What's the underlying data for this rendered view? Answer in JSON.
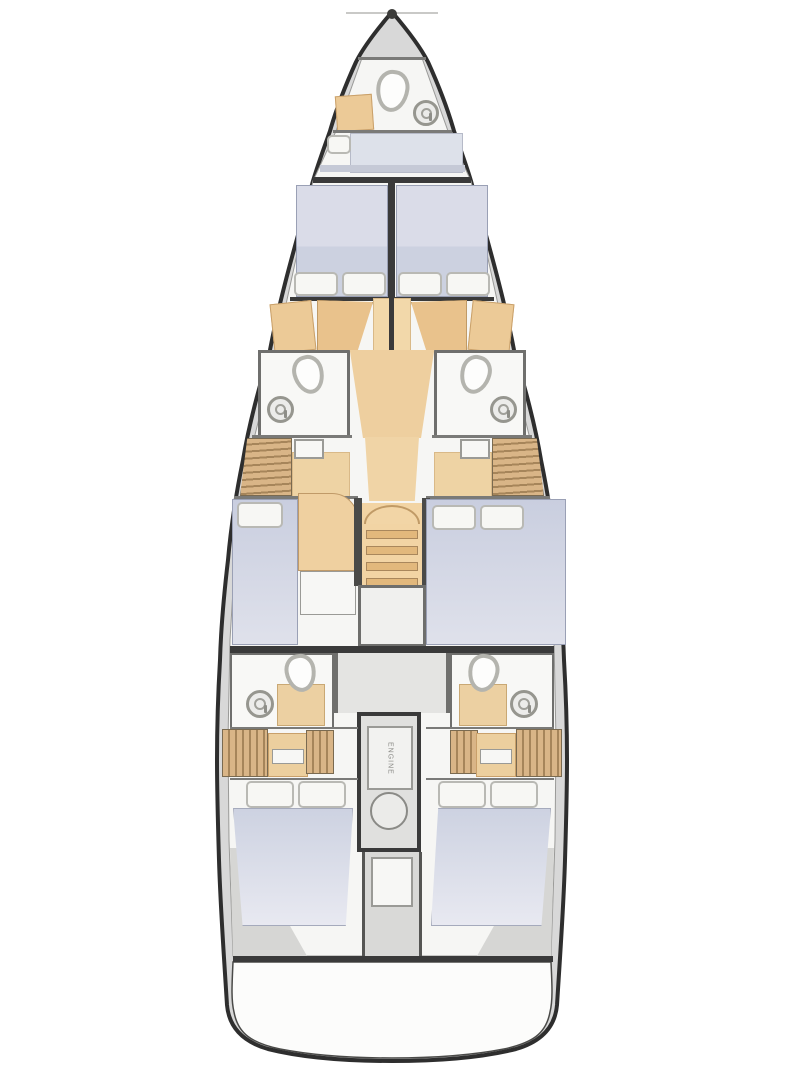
{
  "document": {
    "title": "Sailing yacht interior deck plan",
    "type": "floor-plan",
    "orientation": "bow-up"
  },
  "engine_room": {
    "label": "ENGINE"
  },
  "palette": {
    "hull_outline": "#2e2e2e",
    "deck_gray": "#d8d8d8",
    "floor_white": "#f6f6f4",
    "wood_light": "#f2d6a8",
    "wood_mid": "#e9c28c",
    "locker_stripe": "#d9b587",
    "locker_stripe_dark": "#a6855a",
    "bed_fabric": "#ccd1e0",
    "bed_fabric_light": "#e6e7f0",
    "pillow_white": "#f7f7f4",
    "fixture_outline": "#b4b4ae",
    "bulkhead_dark": "#3a3a3a"
  },
  "rooms": {
    "bow_head": {
      "fixtures": [
        "toilet",
        "round-sink",
        "cabinet"
      ]
    },
    "bow_berth": {
      "fixtures": [
        "berth-cushion",
        "pillow"
      ]
    },
    "forward_cabins": [
      {
        "side": "port",
        "fixtures": [
          "bed",
          "pillow",
          "pillow",
          "desk",
          "cabinet"
        ]
      },
      {
        "side": "starboard",
        "fixtures": [
          "bed",
          "pillow",
          "pillow",
          "desk",
          "cabinet"
        ]
      }
    ],
    "mid_heads": [
      {
        "side": "port",
        "fixtures": [
          "toilet",
          "round-sink"
        ]
      },
      {
        "side": "starboard",
        "fixtures": [
          "toilet",
          "round-sink"
        ]
      }
    ],
    "mid_cabins": [
      {
        "side": "port",
        "fixtures": [
          "bed",
          "pillow",
          "hanging-locker",
          "seat",
          "cabinet"
        ]
      },
      {
        "side": "starboard",
        "fixtures": [
          "bed",
          "pillow",
          "pillow",
          "hanging-locker",
          "seat"
        ]
      }
    ],
    "companionway": {
      "fixtures": [
        "stairs",
        "landing"
      ]
    },
    "aft_heads": [
      {
        "side": "port",
        "fixtures": [
          "toilet",
          "round-sink",
          "shower-tray"
        ]
      },
      {
        "side": "starboard",
        "fixtures": [
          "toilet",
          "round-sink",
          "shower-tray"
        ]
      }
    ],
    "aft_cabins": [
      {
        "side": "port",
        "fixtures": [
          "bed",
          "pillow",
          "pillow",
          "hanging-locker",
          "step"
        ]
      },
      {
        "side": "starboard",
        "fixtures": [
          "bed",
          "pillow",
          "pillow",
          "hanging-locker",
          "step"
        ]
      }
    ],
    "engine_compartment": {
      "fixtures": [
        "engine",
        "access-panel",
        "aft-locker-hatch"
      ]
    },
    "transom": {
      "fixtures": [
        "swim-platform"
      ]
    }
  }
}
